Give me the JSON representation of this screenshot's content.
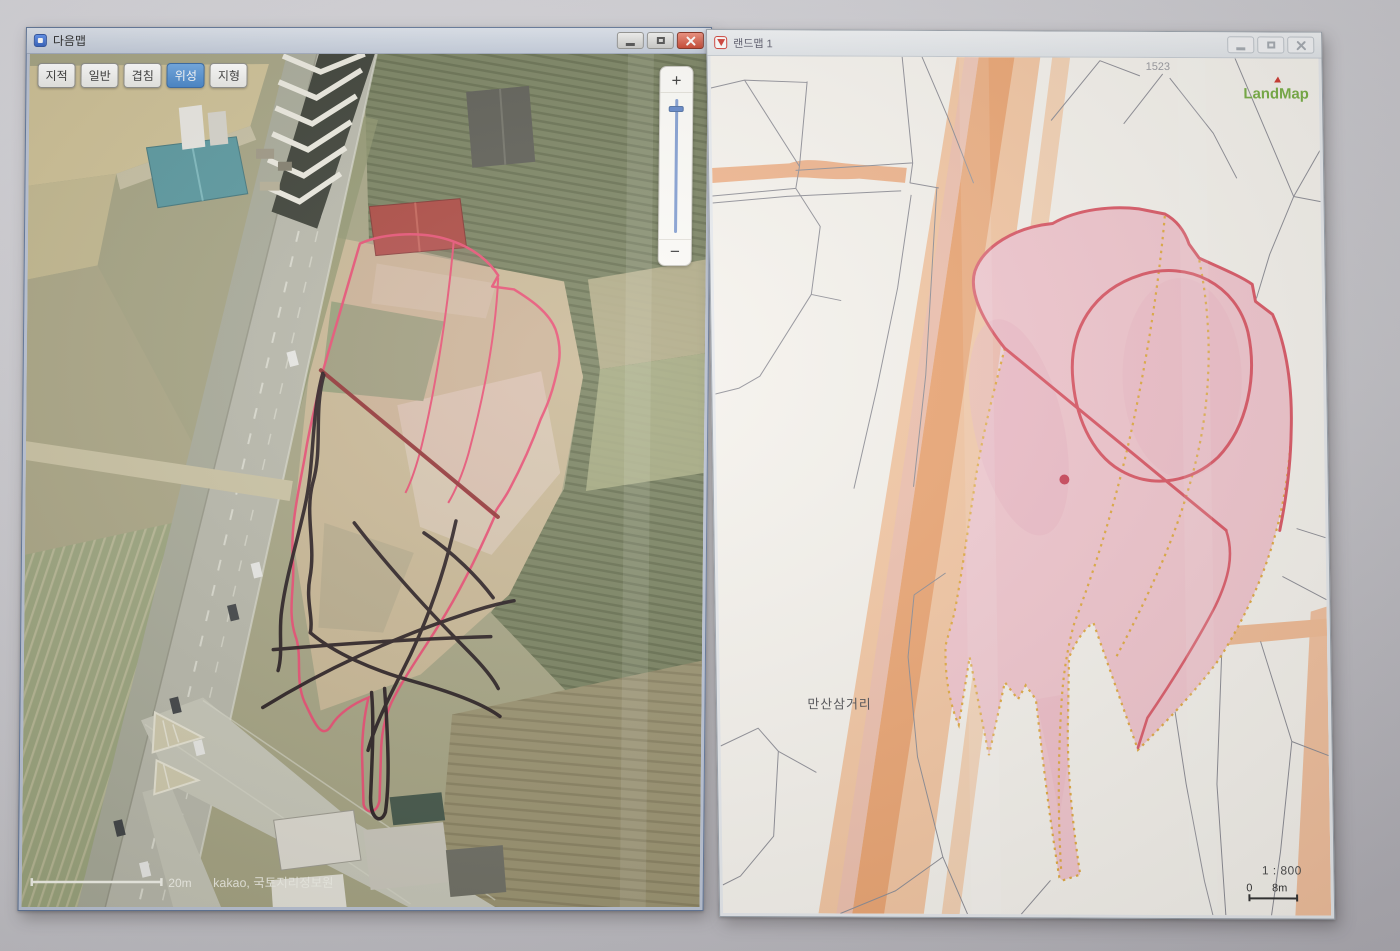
{
  "left_window": {
    "title": "다음맵",
    "window_control_icons": [
      "minimize",
      "maximize",
      "close"
    ],
    "map_type_buttons": [
      {
        "label": "지적",
        "active": false
      },
      {
        "label": "일반",
        "active": false
      },
      {
        "label": "겹침",
        "active": false
      },
      {
        "label": "위성",
        "active": true
      },
      {
        "label": "지형",
        "active": false
      }
    ],
    "zoom_control": {
      "zoom_in": "+",
      "zoom_out": "−"
    },
    "scale_bar_label": "20m",
    "attribution": "kakao, 국토지리정보원"
  },
  "right_window": {
    "title": "랜드맵 1",
    "window_control_icons": [
      "minimize",
      "maximize",
      "close"
    ],
    "logo_text": "LandMap",
    "map_labels": {
      "intersection_name": "만산삼거리",
      "parcel_number": "1523"
    },
    "scale_ratio": "1 : 800",
    "scale_bar": {
      "start": "0",
      "end": "8m"
    }
  },
  "colors": {
    "satellite_annotation_pink": "#e64a6e",
    "satellite_annotation_dark_red": "#8c2b2b",
    "hand_drawn_marker_black": "#1c1115",
    "cadastral_parcel_pink": "#f3c7cf",
    "cadastral_boundary_red": "#dc5664",
    "cadastral_dotted_yellow": "#e3ab40",
    "cadastral_road_orange": "#f0ab79",
    "active_map_type_blue": "#4a8fd4",
    "landmap_logo_green": "#76ae41"
  }
}
